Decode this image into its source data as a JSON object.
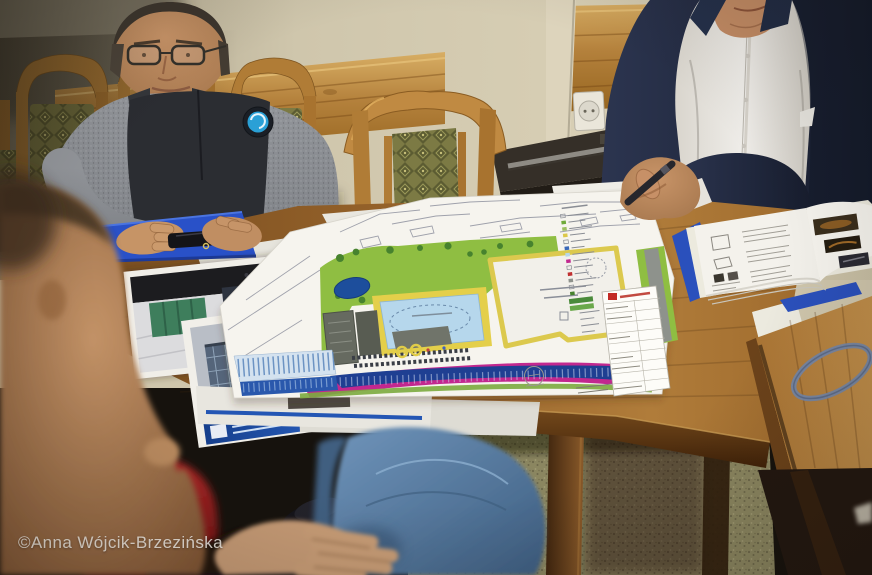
{
  "image": {
    "width": 872,
    "height": 575,
    "kind": "photograph"
  },
  "watermark": {
    "text": "©Anna Wójcik-Brzezińska",
    "color": "#f8f5ee"
  },
  "scene": {
    "description": "Meeting around a wooden table: men reviewing a colored architectural site plan of a municipal swimming-pool complex",
    "environment": {
      "wall": "cream plaster wall with horizontal pine wainscot panels",
      "floor": "olive speckled carpet",
      "furniture": [
        "wooden chairs with green diamond-pattern upholstery",
        "dark side desk with metal rail",
        "wall power outlet"
      ]
    },
    "people": [
      {
        "id": "man-left",
        "description": "man with glasses in grey-and-black fleece with round blue logo patch, hands resting on a blue folder"
      },
      {
        "id": "man-right",
        "description": "older man in navy suit and white shirt holding a dark pen over an open brochure"
      },
      {
        "id": "man-foreground",
        "description": "out-of-focus man in red shirt seen from behind, hand resting on denim-clad knee under the table"
      }
    ],
    "documents": {
      "site_plan": {
        "description": "large site plan sheet with grey survey linework, green landscaping, yellow paths, light-blue pool, dark-blue pond and parking, magenta road band, grey buildings, white building footprint; annotation text too small to read",
        "legend": "column of tiny legend rows with colour swatches",
        "title_block": {
          "logo_color": "#c22a24",
          "note": "title block rows illegible"
        }
      },
      "photo_prints": [
        {
          "id": "interior-rendering",
          "description": "print of pool-hall interior with green wall panel"
        },
        {
          "id": "exterior-rendering",
          "description": "print of glazed building facade with blue caption band"
        }
      ],
      "blue_folder": {
        "color": "#2951c8"
      },
      "open_brochure": {
        "description": "bound report in blue cover, left page diagrams, right page dark photos"
      },
      "paper_stack": {
        "description": "several white sheets under and beside the plan"
      },
      "rubber_band": {
        "color": "#7487a8",
        "location": "on side table"
      }
    }
  },
  "palette": {
    "wall": "#cfc6ac",
    "wood_panel": "#b4813c",
    "chair_wood": "#b07c36",
    "upholstery": "#7c7a44",
    "table_wood": "#95622a",
    "suit_navy": "#1e2536",
    "shirt": "#efede9",
    "fleece_dark": "#2b2d32",
    "fleece_grey": "#93969b",
    "logo_blue": "#2aa0d6",
    "jeans": "#5d83aa",
    "red_shirt": "#a02020",
    "carpet": "#8b8660",
    "plan_green": "#8fbe42",
    "plan_yellow": "#e4cf4a",
    "plan_pool": "#b6d7ec",
    "plan_pond": "#1d4e9c",
    "plan_magenta": "#c2288f",
    "plan_parking": "#1f3f92"
  }
}
